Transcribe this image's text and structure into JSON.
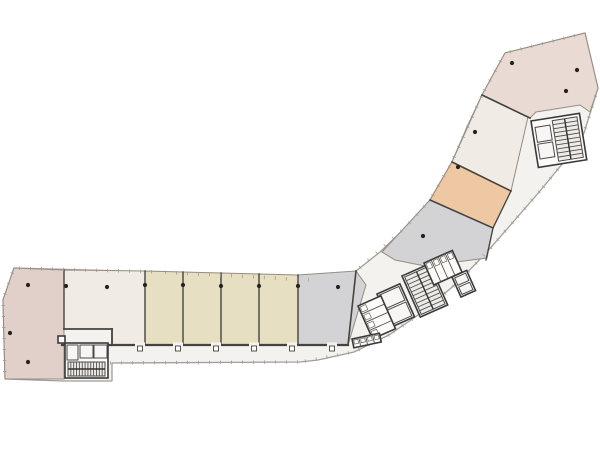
{
  "floorplan": {
    "canvas": {
      "width": 600,
      "height": 450,
      "background": "#ffffff"
    },
    "palette": {
      "corridor": "#f4f2ee",
      "outside": "#ffffff",
      "wall_dark": "#46423e",
      "wall_mid": "#6b645c",
      "wall_light": "#a19d97",
      "room_stroke": "#948d83",
      "core_fill": "#fcfbf9",
      "box_fill": "#f7f6f4",
      "stair_fill": "#edebe8",
      "column": "#262220",
      "mauve": "#e1d0c9",
      "pink": "#e9dad3",
      "cream": "#f0ebe4",
      "tan": "#e6dfc1",
      "orange": "#edc8a3",
      "gray": "#d3d3d5"
    },
    "outline": [
      [
        14,
        268
      ],
      [
        160,
        272
      ],
      [
        310,
        280
      ],
      [
        356,
        271
      ],
      [
        380,
        252
      ],
      [
        406,
        227
      ],
      [
        430,
        200
      ],
      [
        452,
        162
      ],
      [
        467,
        127
      ],
      [
        482,
        95
      ],
      [
        505,
        53
      ],
      [
        585,
        33
      ],
      [
        598,
        88
      ],
      [
        584,
        133
      ],
      [
        563,
        163
      ],
      [
        540,
        191
      ],
      [
        514,
        221
      ],
      [
        487,
        252
      ],
      [
        457,
        283
      ],
      [
        424,
        311
      ],
      [
        389,
        335
      ],
      [
        354,
        352
      ],
      [
        318,
        360
      ],
      [
        300,
        362
      ],
      [
        112,
        363
      ],
      [
        112,
        381
      ],
      [
        63,
        381
      ],
      [
        5,
        379
      ],
      [
        3,
        300
      ]
    ],
    "rooms": [
      {
        "name": "room-large-left",
        "fill": "mauve",
        "points": [
          [
            14,
            268
          ],
          [
            64,
            270
          ],
          [
            64,
            379
          ],
          [
            5,
            379
          ],
          [
            3,
            300
          ]
        ]
      },
      {
        "name": "room-cream-left",
        "fill": "cream",
        "points": [
          [
            64,
            270
          ],
          [
            145,
            271
          ],
          [
            145,
            345
          ],
          [
            112,
            345
          ],
          [
            112,
            329
          ],
          [
            64,
            329
          ]
        ]
      },
      {
        "name": "room-tan-1",
        "fill": "tan",
        "points": [
          [
            145,
            271
          ],
          [
            183,
            272
          ],
          [
            183,
            345
          ],
          [
            145,
            345
          ]
        ]
      },
      {
        "name": "room-tan-2",
        "fill": "tan",
        "points": [
          [
            183,
            272
          ],
          [
            221,
            273
          ],
          [
            221,
            345
          ],
          [
            183,
            345
          ]
        ]
      },
      {
        "name": "room-tan-3",
        "fill": "tan",
        "points": [
          [
            221,
            273
          ],
          [
            259,
            274
          ],
          [
            259,
            345
          ],
          [
            221,
            345
          ]
        ]
      },
      {
        "name": "room-tan-4",
        "fill": "tan",
        "points": [
          [
            259,
            274
          ],
          [
            298,
            275
          ],
          [
            298,
            345
          ],
          [
            259,
            345
          ]
        ]
      },
      {
        "name": "room-gray-left",
        "fill": "gray",
        "points": [
          [
            298,
            275
          ],
          [
            356,
            271
          ],
          [
            366,
            285
          ],
          [
            348,
            345
          ],
          [
            298,
            345
          ]
        ]
      },
      {
        "name": "room-gray-right",
        "fill": "gray",
        "points": [
          [
            382,
            252
          ],
          [
            430,
            200
          ],
          [
            493,
            228
          ],
          [
            487,
            258
          ],
          [
            425,
            266
          ],
          [
            395,
            260
          ]
        ]
      },
      {
        "name": "room-orange",
        "fill": "orange",
        "points": [
          [
            430,
            200
          ],
          [
            452,
            162
          ],
          [
            511,
            191
          ],
          [
            493,
            228
          ]
        ]
      },
      {
        "name": "room-cream-right",
        "fill": "cream",
        "points": [
          [
            452,
            162
          ],
          [
            482,
            95
          ],
          [
            528,
            117
          ],
          [
            511,
            191
          ]
        ]
      },
      {
        "name": "room-pink-top",
        "fill": "pink",
        "points": [
          [
            482,
            95
          ],
          [
            505,
            53
          ],
          [
            585,
            33
          ],
          [
            598,
            88
          ],
          [
            590,
            112
          ],
          [
            580,
            105
          ],
          [
            536,
            112
          ],
          [
            530,
            118
          ]
        ]
      }
    ],
    "walls": [
      {
        "points": [
          [
            64,
            270
          ],
          [
            64,
            329
          ]
        ],
        "w": 1.4
      },
      {
        "points": [
          [
            145,
            271
          ],
          [
            145,
            344
          ]
        ],
        "w": 1.4
      },
      {
        "points": [
          [
            183,
            272
          ],
          [
            183,
            344
          ]
        ],
        "w": 1.4
      },
      {
        "points": [
          [
            221,
            273
          ],
          [
            221,
            344
          ]
        ],
        "w": 1.4
      },
      {
        "points": [
          [
            259,
            274
          ],
          [
            259,
            344
          ]
        ],
        "w": 1.4
      },
      {
        "points": [
          [
            298,
            275
          ],
          [
            298,
            344
          ]
        ],
        "w": 1.4
      },
      {
        "points": [
          [
            64,
            329
          ],
          [
            112,
            329
          ]
        ],
        "w": 1.8
      },
      {
        "points": [
          [
            112,
            329
          ],
          [
            112,
            345
          ]
        ],
        "w": 1.8
      },
      {
        "points": [
          [
            62,
            345
          ],
          [
            348,
            345
          ]
        ],
        "w": 2.2
      },
      {
        "points": [
          [
            348,
            345
          ],
          [
            356,
            271
          ]
        ],
        "w": 1.6
      },
      {
        "points": [
          [
            430,
            200
          ],
          [
            493,
            228
          ]
        ],
        "w": 1.6
      },
      {
        "points": [
          [
            493,
            228
          ],
          [
            486,
            260
          ]
        ],
        "w": 1.3
      },
      {
        "points": [
          [
            452,
            162
          ],
          [
            511,
            191
          ]
        ],
        "w": 1.6
      },
      {
        "points": [
          [
            511,
            191
          ],
          [
            493,
            228
          ]
        ],
        "w": 1.3
      },
      {
        "points": [
          [
            482,
            95
          ],
          [
            530,
            118
          ]
        ],
        "w": 1.6
      }
    ],
    "ticks": {
      "spacing": 11,
      "len": 3.5,
      "lines": [
        [
          [
            72,
            363
          ],
          [
            300,
            362
          ],
          [
            354,
            352
          ],
          [
            389,
            335
          ],
          [
            424,
            311
          ],
          [
            457,
            283
          ],
          [
            487,
            252
          ],
          [
            514,
            221
          ],
          [
            540,
            191
          ],
          [
            563,
            163
          ],
          [
            584,
            133
          ],
          [
            598,
            88
          ]
        ],
        [
          [
            14,
            268
          ],
          [
            160,
            272
          ],
          [
            310,
            280
          ]
        ],
        [
          [
            356,
            271
          ],
          [
            406,
            227
          ],
          [
            430,
            200
          ],
          [
            452,
            162
          ],
          [
            482,
            95
          ]
        ],
        [
          [
            482,
            95
          ],
          [
            505,
            53
          ],
          [
            585,
            33
          ]
        ],
        [
          [
            14,
            268
          ],
          [
            3,
            300
          ],
          [
            5,
            379
          ]
        ]
      ]
    },
    "columns": [
      [
        28,
        285
      ],
      [
        66,
        286
      ],
      [
        107,
        287
      ],
      [
        145,
        285
      ],
      [
        183,
        285
      ],
      [
        221,
        286
      ],
      [
        259,
        286
      ],
      [
        298,
        286
      ],
      [
        338,
        287
      ],
      [
        10,
        333
      ],
      [
        28,
        362
      ],
      [
        423,
        236
      ],
      [
        458,
        167
      ],
      [
        475,
        132
      ],
      [
        512,
        63
      ],
      [
        577,
        70
      ],
      [
        566,
        91
      ]
    ],
    "doors": [
      [
        140,
        345
      ],
      [
        178,
        345
      ],
      [
        216,
        345
      ],
      [
        254,
        345
      ],
      [
        292,
        345
      ],
      [
        332,
        345
      ]
    ],
    "cores": [
      {
        "name": "core-stair-bottom-left",
        "x": 65,
        "y": 343,
        "angle": 0,
        "outer": {
          "w": 43,
          "h": 35
        },
        "boxes": [
          [
            15,
            2,
            13,
            13
          ],
          [
            29,
            2,
            13,
            13
          ],
          [
            2,
            2,
            11,
            15
          ]
        ],
        "stair": {
          "x": 3,
          "y": 19,
          "w": 37,
          "h": 14,
          "treads": 12,
          "vertical": true
        }
      },
      {
        "name": "core-stair-top-right",
        "x": 531,
        "y": 121,
        "angle": -9,
        "outer": {
          "w": 49,
          "h": 47
        },
        "boxes": [
          [
            3,
            7,
            15,
            15
          ],
          [
            3,
            24,
            15,
            15
          ]
        ],
        "stair": {
          "x": 21,
          "y": 3,
          "w": 25,
          "h": 41,
          "treads": 9,
          "vertical": false
        }
      },
      {
        "name": "core-central-stair",
        "x": 402,
        "y": 276,
        "angle": -24,
        "outer": {
          "w": 30,
          "h": 45
        },
        "stair": {
          "x": 2,
          "y": 2,
          "w": 26,
          "h": 41,
          "treads": 9,
          "vertical": false
        }
      },
      {
        "name": "core-central-elevators",
        "x": 377,
        "y": 294,
        "angle": -24,
        "outer": {
          "w": 25,
          "h": 36
        },
        "boxes": [
          [
            2,
            2,
            21,
            15
          ],
          [
            2,
            19,
            21,
            15
          ]
        ]
      },
      {
        "name": "core-central-wc-upper",
        "x": 424,
        "y": 263,
        "angle": -24,
        "outer": {
          "w": 31,
          "h": 24
        },
        "stalls": {
          "count": 4,
          "vertical": true
        }
      },
      {
        "name": "core-central-wc-lower",
        "x": 358,
        "y": 306,
        "angle": -24,
        "outer": {
          "w": 25,
          "h": 36
        },
        "stalls": {
          "count": 4,
          "vertical": false
        }
      },
      {
        "name": "core-central-rooms",
        "x": 452,
        "y": 277,
        "angle": -24,
        "outer": {
          "w": 16,
          "h": 22
        },
        "boxes": [
          [
            2,
            2,
            12,
            8
          ],
          [
            2,
            12,
            12,
            8
          ]
        ]
      },
      {
        "name": "core-wc-fixtures-row",
        "x": 352,
        "y": 339,
        "angle": -12,
        "outer": {
          "w": 28,
          "h": 9
        },
        "stalls": {
          "count": 4,
          "vertical": true
        }
      },
      {
        "name": "core-duct-bottom",
        "x": 58,
        "y": 336,
        "angle": 0,
        "outer": {
          "w": 7,
          "h": 7
        }
      }
    ]
  }
}
